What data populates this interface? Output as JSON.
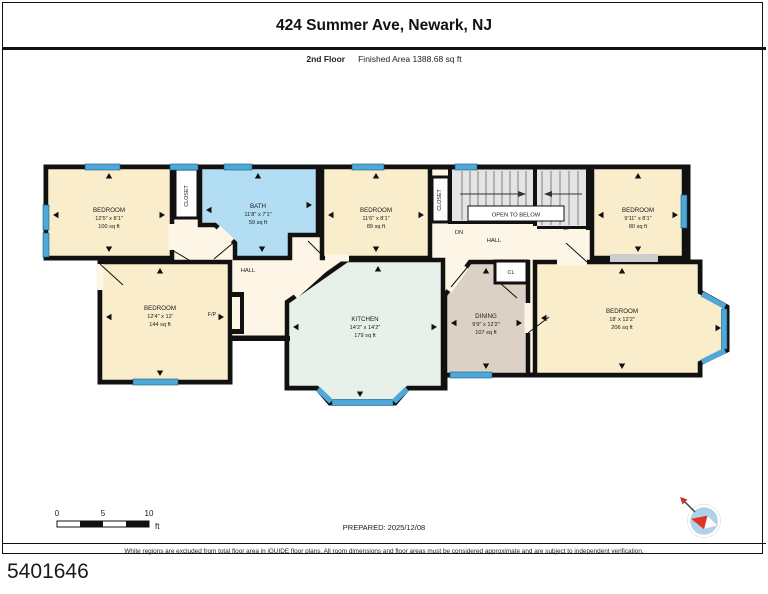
{
  "header": {
    "title": "424 Summer Ave, Newark, NJ",
    "floor_label": "2nd Floor",
    "area_label": "Finished Area 1388.68 sq ft"
  },
  "rooms": [
    {
      "id": "bedroom-top-left",
      "name": "BEDROOM",
      "dims": "12'5\" x 8'1\"",
      "area": "100 sq ft"
    },
    {
      "id": "bath",
      "name": "BATH",
      "dims": "11'8\" x 7'1\"",
      "area": "59 sq ft"
    },
    {
      "id": "bedroom-top-middle",
      "name": "BEDROOM",
      "dims": "11'6\" x 8'1\"",
      "area": "89 sq ft"
    },
    {
      "id": "bedroom-top-right",
      "name": "BEDROOM",
      "dims": "9'11\" x 8'1\"",
      "area": "80 sq ft"
    },
    {
      "id": "bedroom-bottom-left",
      "name": "BEDROOM",
      "dims": "12'4\" x 12'",
      "area": "144 sq ft"
    },
    {
      "id": "kitchen",
      "name": "KITCHEN",
      "dims": "14'2\" x 14'2\"",
      "area": "179 sq ft"
    },
    {
      "id": "dining",
      "name": "DINING",
      "dims": "9'9\" x 12'2\"",
      "area": "107 sq ft"
    },
    {
      "id": "bedroom-right",
      "name": "BEDROOM",
      "dims": "18' x 12'2\"",
      "area": "206 sq ft"
    }
  ],
  "labels": {
    "hall_left": "HALL",
    "hall_right": "HALL",
    "closet_left": "CLOSET",
    "closet_middle": "CLOSET",
    "closet_small": "CL",
    "open_to_below": "OPEN TO BELOW",
    "stairs_down": "DN",
    "stairs_up": "UP",
    "fireplace": "F/P"
  },
  "scale_bar": {
    "t0": "0",
    "t5": "5",
    "t10": "10",
    "unit": "ft"
  },
  "footer": {
    "prepared": "PREPARED: 2025/12/08",
    "disclaimer": "White regions are excluded from total floor area in iGUIDE floor plans. All room dimensions and floor areas must be considered approximate and are subject to independent verification.",
    "plan_id": "5401646"
  },
  "colors": {
    "bedroom": "#FAEDCB",
    "bath": "#B3DDF2",
    "kitchen": "#E7F0E9",
    "dining": "#DBD2C5",
    "hall": "#FDF6E7",
    "stairs": "#E4E4E4",
    "window": "#4FA8DA",
    "wall": "#111111"
  }
}
